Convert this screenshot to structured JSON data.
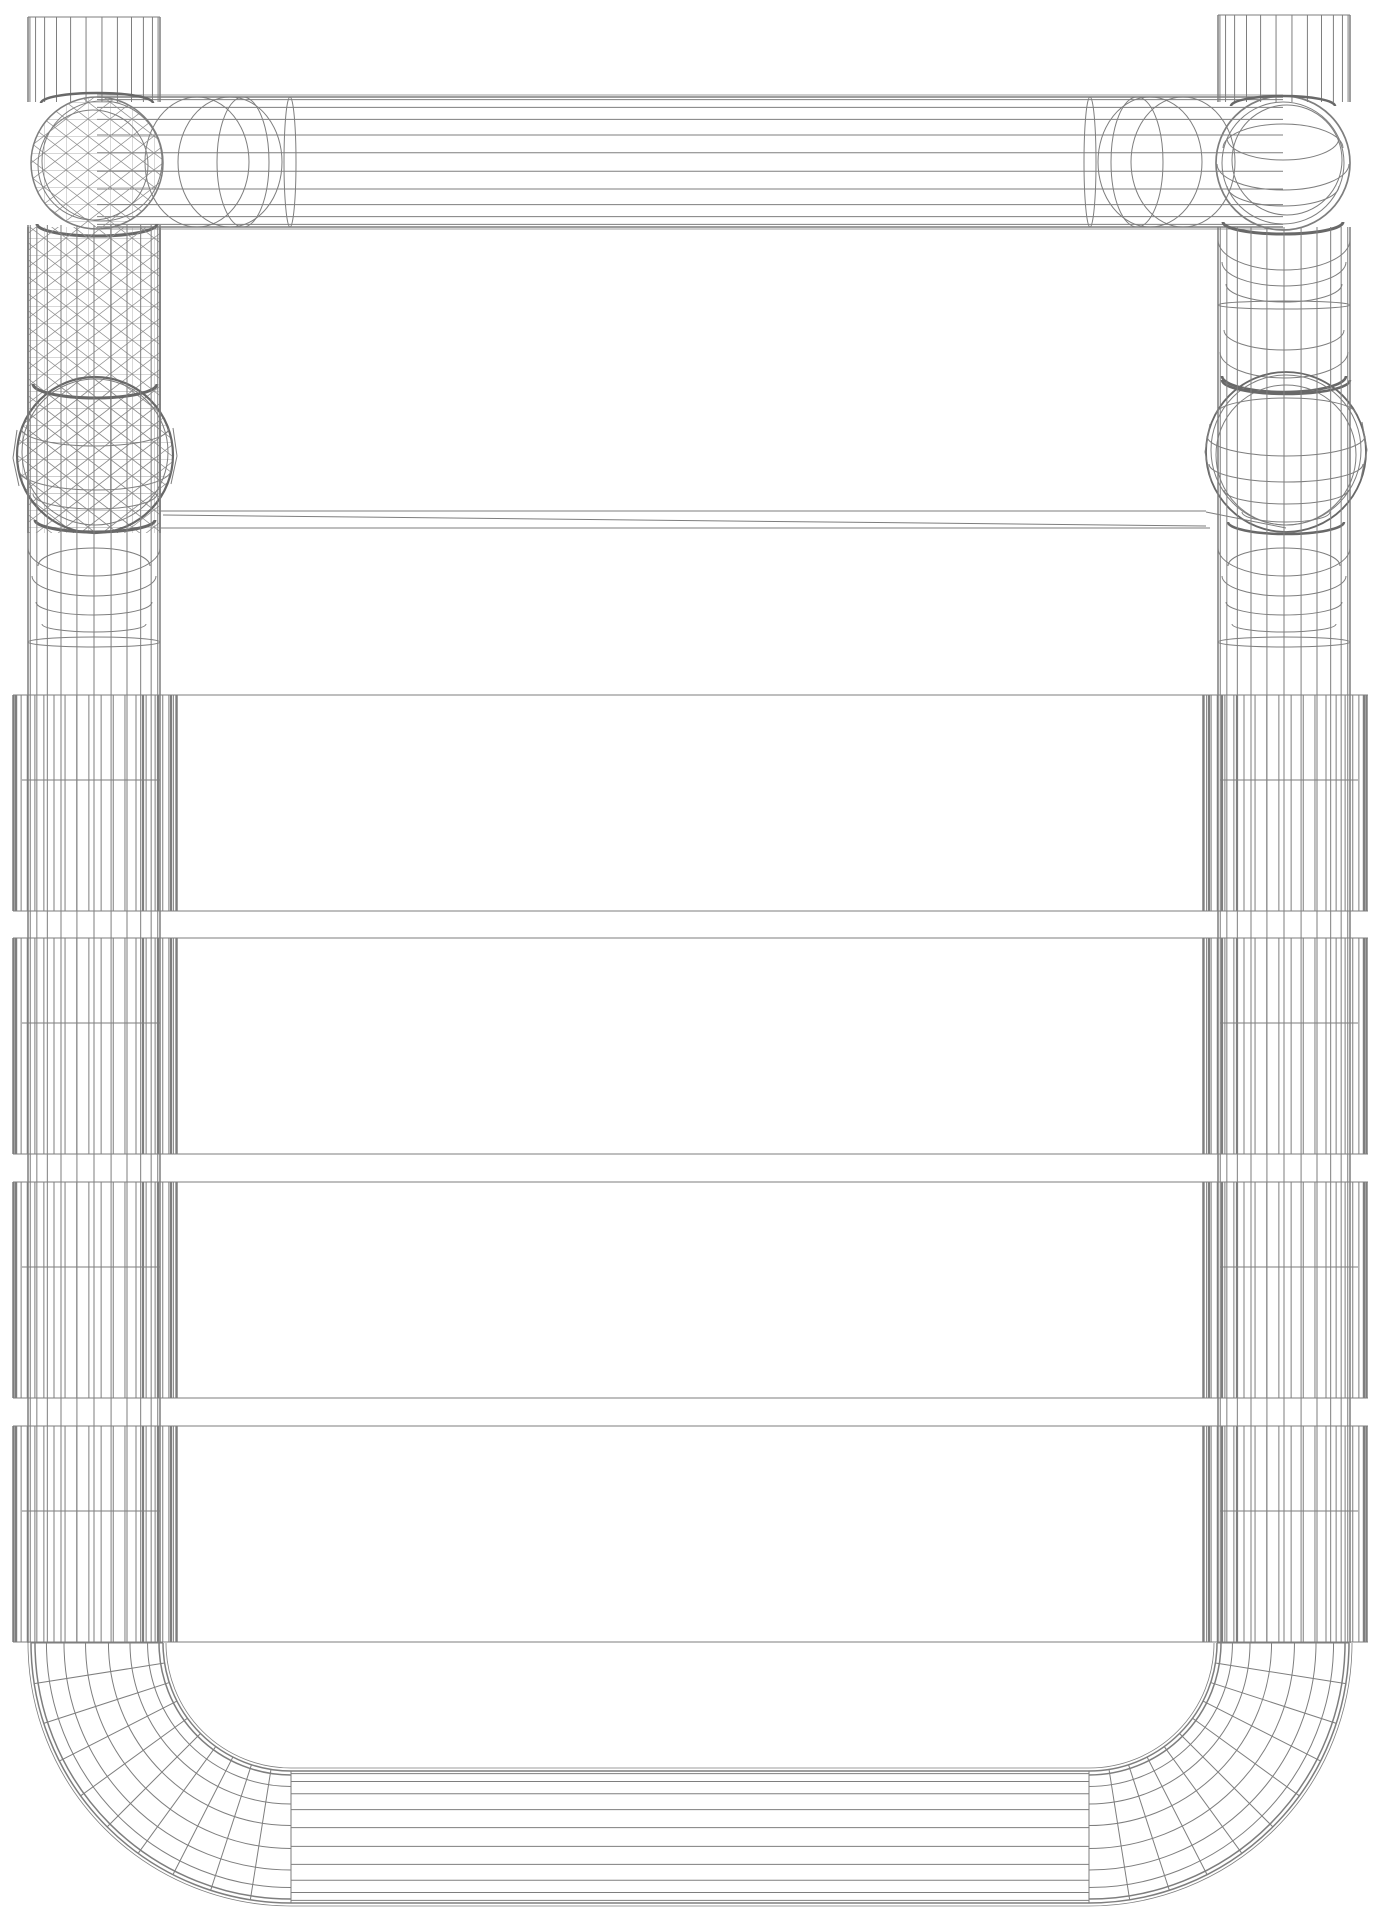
{
  "scene": {
    "width": 1380,
    "height": 1920,
    "background": "#ffffff",
    "stroke_color": "#7e7e7e",
    "stroke_dark": "#686868",
    "mesh_color": "#919191",
    "mesh_tile_w": 22,
    "mesh_tile_h": 17,
    "mesh_stroke_w": 0.7
  },
  "groups": [
    {
      "name": "top-tube",
      "ops": [
        {
          "t": "hset",
          "cy": 162,
          "r": 65,
          "n": 12,
          "x1": 97,
          "x2": 1283
        },
        {
          "t": "line",
          "x1": 97,
          "y1": 95,
          "x2": 1283,
          "y2": 95,
          "w": 0.8
        },
        {
          "t": "line",
          "x1": 97,
          "y1": 229,
          "x2": 1283,
          "y2": 229,
          "w": 0.8
        },
        {
          "t": "ellipse",
          "cx": 197,
          "cy": 162,
          "rx": 52,
          "ry": 65,
          "w": 1
        },
        {
          "t": "ellipse",
          "cx": 230,
          "cy": 162,
          "rx": 52,
          "ry": 65,
          "w": 1
        },
        {
          "t": "ellipse",
          "cx": 243,
          "cy": 162,
          "rx": 26,
          "ry": 65,
          "w": 1
        },
        {
          "t": "ellipse",
          "cx": 290,
          "cy": 162,
          "rx": 6,
          "ry": 65,
          "w": 1
        },
        {
          "t": "ellipse",
          "cx": 1183,
          "cy": 162,
          "rx": 52,
          "ry": 65,
          "w": 1
        },
        {
          "t": "ellipse",
          "cx": 1150,
          "cy": 162,
          "rx": 52,
          "ry": 65,
          "w": 1
        },
        {
          "t": "ellipse",
          "cx": 1137,
          "cy": 162,
          "rx": 26,
          "ry": 65,
          "w": 1
        },
        {
          "t": "ellipse",
          "cx": 1090,
          "cy": 162,
          "rx": 6,
          "ry": 65,
          "w": 1
        }
      ]
    },
    {
      "name": "top-left-stub",
      "ops": [
        {
          "t": "vset",
          "cx": 94,
          "r": 66,
          "n": 14,
          "y1": 17,
          "y2": 102
        },
        {
          "t": "line",
          "x1": 28,
          "y1": 17,
          "x2": 160,
          "y2": 17,
          "w": 1
        }
      ]
    },
    {
      "name": "top-right-stub",
      "ops": [
        {
          "t": "vset",
          "cx": 1284,
          "r": 66,
          "n": 14,
          "y1": 15,
          "y2": 102
        },
        {
          "t": "line",
          "x1": 1218,
          "y1": 15,
          "x2": 1350,
          "y2": 15,
          "w": 1
        }
      ]
    },
    {
      "name": "left-elbow-joint",
      "ops": [
        {
          "t": "meshcircle",
          "cx": 97,
          "cy": 163,
          "r": 66
        },
        {
          "t": "circle",
          "cx": 97,
          "cy": 163,
          "r": 66,
          "w": 1.5
        },
        {
          "t": "circle",
          "cx": 102,
          "cy": 161,
          "r": 60,
          "w": 1
        },
        {
          "t": "circle",
          "cx": 93,
          "cy": 165,
          "r": 55,
          "w": 1
        },
        {
          "t": "arc",
          "cx": 97,
          "cy": 224,
          "rx": 60,
          "ry": 12,
          "half": "b",
          "w": 3,
          "dark": true
        },
        {
          "t": "arc",
          "cx": 97,
          "cy": 103,
          "rx": 56,
          "ry": 10,
          "half": "t",
          "w": 2.5,
          "dark": true
        }
      ]
    },
    {
      "name": "right-elbow-joint",
      "ops": [
        {
          "t": "circle",
          "cx": 1283,
          "cy": 163,
          "r": 67,
          "w": 1.7
        },
        {
          "t": "circle",
          "cx": 1283,
          "cy": 163,
          "r": 61,
          "w": 1
        },
        {
          "t": "circle",
          "cx": 1287,
          "cy": 160,
          "r": 55,
          "w": 1
        },
        {
          "t": "arc",
          "cx": 1283,
          "cy": 138,
          "rx": 56,
          "ry": 22,
          "half": "b",
          "w": 1
        },
        {
          "t": "arc",
          "cx": 1283,
          "cy": 164,
          "rx": 66,
          "ry": 26,
          "half": "b",
          "w": 1
        },
        {
          "t": "arc",
          "cx": 1283,
          "cy": 186,
          "rx": 56,
          "ry": 20,
          "half": "b",
          "w": 1
        },
        {
          "t": "arc",
          "cx": 1283,
          "cy": 148,
          "rx": 60,
          "ry": 24,
          "half": "t",
          "w": 1
        },
        {
          "t": "arc",
          "cx": 1283,
          "cy": 222,
          "rx": 60,
          "ry": 12,
          "half": "b",
          "w": 3,
          "dark": true
        },
        {
          "t": "arc",
          "cx": 1283,
          "cy": 106,
          "rx": 52,
          "ry": 10,
          "half": "t",
          "w": 2.5,
          "dark": true
        }
      ]
    },
    {
      "name": "left-tube-mesh-section",
      "ops": [
        {
          "t": "meshrect",
          "x": 28,
          "y": 227,
          "w": 132,
          "h": 306
        },
        {
          "t": "line",
          "x1": 28,
          "y1": 227,
          "x2": 28,
          "y2": 533,
          "w": 1.8
        },
        {
          "t": "line",
          "x1": 160,
          "y1": 227,
          "x2": 160,
          "y2": 533,
          "w": 1.8
        }
      ]
    },
    {
      "name": "right-tube-upper-rings",
      "ops": [
        {
          "t": "arc",
          "cx": 1284,
          "cy": 240,
          "rx": 66,
          "ry": 30,
          "half": "b",
          "w": 1
        },
        {
          "t": "arc",
          "cx": 1284,
          "cy": 262,
          "rx": 62,
          "ry": 24,
          "half": "b",
          "w": 1
        },
        {
          "t": "arc",
          "cx": 1284,
          "cy": 284,
          "rx": 58,
          "ry": 18,
          "half": "b",
          "w": 1
        },
        {
          "t": "ellipse",
          "cx": 1284,
          "cy": 305,
          "rx": 66,
          "ry": 4,
          "w": 1
        },
        {
          "t": "arc",
          "cx": 1284,
          "cy": 330,
          "rx": 60,
          "ry": 20,
          "half": "b",
          "w": 1
        },
        {
          "t": "arc",
          "cx": 1284,
          "cy": 352,
          "rx": 64,
          "ry": 26,
          "half": "b",
          "w": 1
        },
        {
          "t": "arc",
          "cx": 1284,
          "cy": 376,
          "rx": 62,
          "ry": 16,
          "half": "b",
          "w": 2.6,
          "dark": true
        }
      ]
    },
    {
      "name": "left-sphere-joint",
      "ops": [
        {
          "t": "meshcircle",
          "cx": 95,
          "cy": 455,
          "r": 78
        },
        {
          "t": "circle",
          "cx": 95,
          "cy": 455,
          "r": 78,
          "w": 2.2,
          "dark": true
        },
        {
          "t": "circle",
          "cx": 95,
          "cy": 452,
          "r": 73,
          "w": 1
        },
        {
          "t": "arc",
          "cx": 95,
          "cy": 428,
          "rx": 74,
          "ry": 18,
          "half": "b",
          "w": 1
        },
        {
          "t": "arc",
          "cx": 95,
          "cy": 470,
          "rx": 76,
          "ry": 20,
          "half": "b",
          "w": 1
        },
        {
          "t": "arc",
          "cx": 95,
          "cy": 494,
          "rx": 62,
          "ry": 15,
          "half": "b",
          "w": 1
        },
        {
          "t": "arc",
          "cx": 95,
          "cy": 384,
          "rx": 62,
          "ry": 14,
          "half": "b",
          "w": 3,
          "dark": true
        },
        {
          "t": "arc",
          "cx": 95,
          "cy": 520,
          "rx": 60,
          "ry": 12,
          "half": "b",
          "w": 3,
          "dark": true
        },
        {
          "t": "line",
          "x1": 17,
          "y1": 430,
          "x2": 13,
          "y2": 458,
          "w": 1
        },
        {
          "t": "line",
          "x1": 13,
          "y1": 458,
          "x2": 19,
          "y2": 486,
          "w": 1
        },
        {
          "t": "line",
          "x1": 173,
          "y1": 428,
          "x2": 177,
          "y2": 456,
          "w": 1
        },
        {
          "t": "line",
          "x1": 177,
          "y1": 456,
          "x2": 171,
          "y2": 484,
          "w": 1
        }
      ]
    },
    {
      "name": "right-sphere-joint",
      "ops": [
        {
          "t": "circle",
          "cx": 1286,
          "cy": 452,
          "r": 80,
          "w": 1.8,
          "dark": true
        },
        {
          "t": "circle",
          "cx": 1286,
          "cy": 450,
          "r": 75,
          "w": 1
        },
        {
          "t": "circle",
          "cx": 1286,
          "cy": 455,
          "r": 70,
          "w": 1
        },
        {
          "t": "arc",
          "cx": 1286,
          "cy": 414,
          "rx": 70,
          "ry": 16,
          "half": "t",
          "w": 1
        },
        {
          "t": "arc",
          "cx": 1286,
          "cy": 436,
          "rx": 79,
          "ry": 20,
          "half": "b",
          "w": 1
        },
        {
          "t": "arc",
          "cx": 1286,
          "cy": 464,
          "rx": 77,
          "ry": 18,
          "half": "b",
          "w": 1
        },
        {
          "t": "arc",
          "cx": 1286,
          "cy": 490,
          "rx": 62,
          "ry": 14,
          "half": "b",
          "w": 1
        },
        {
          "t": "arc",
          "cx": 1286,
          "cy": 512,
          "rx": 44,
          "ry": 10,
          "half": "b",
          "w": 1
        },
        {
          "t": "arc",
          "cx": 1286,
          "cy": 380,
          "rx": 64,
          "ry": 14,
          "half": "b",
          "w": 2.5,
          "dark": true
        },
        {
          "t": "arc",
          "cx": 1286,
          "cy": 522,
          "rx": 58,
          "ry": 12,
          "half": "b",
          "w": 2.5,
          "dark": true
        },
        {
          "t": "line",
          "x1": 1210,
          "y1": 424,
          "x2": 1205,
          "y2": 452,
          "w": 1
        },
        {
          "t": "line",
          "x1": 1205,
          "y1": 452,
          "x2": 1211,
          "y2": 480,
          "w": 1
        },
        {
          "t": "line",
          "x1": 1362,
          "y1": 422,
          "x2": 1367,
          "y2": 450,
          "w": 1
        },
        {
          "t": "line",
          "x1": 1367,
          "y1": 450,
          "x2": 1361,
          "y2": 478,
          "w": 1
        },
        {
          "t": "line",
          "x1": 1206,
          "y1": 512,
          "x2": 1286,
          "y2": 528,
          "w": 1
        }
      ]
    },
    {
      "name": "left-tube-lower-rings",
      "ops": [
        {
          "t": "arc",
          "cx": 94,
          "cy": 548,
          "rx": 66,
          "ry": 28,
          "half": "b",
          "w": 1
        },
        {
          "t": "arc",
          "cx": 94,
          "cy": 576,
          "rx": 62,
          "ry": 20,
          "half": "b",
          "w": 1
        },
        {
          "t": "arc",
          "cx": 94,
          "cy": 566,
          "rx": 56,
          "ry": 18,
          "half": "t",
          "w": 1
        },
        {
          "t": "arc",
          "cx": 94,
          "cy": 602,
          "rx": 58,
          "ry": 13,
          "half": "b",
          "w": 1
        },
        {
          "t": "arc",
          "cx": 94,
          "cy": 624,
          "rx": 52,
          "ry": 8,
          "half": "b",
          "w": 1
        },
        {
          "t": "ellipse",
          "cx": 94,
          "cy": 642,
          "rx": 66,
          "ry": 5,
          "w": 1
        }
      ]
    },
    {
      "name": "right-tube-lower-rings",
      "ops": [
        {
          "t": "arc",
          "cx": 1284,
          "cy": 548,
          "rx": 66,
          "ry": 28,
          "half": "b",
          "w": 1
        },
        {
          "t": "arc",
          "cx": 1284,
          "cy": 576,
          "rx": 62,
          "ry": 20,
          "half": "b",
          "w": 1
        },
        {
          "t": "arc",
          "cx": 1284,
          "cy": 566,
          "rx": 56,
          "ry": 18,
          "half": "t",
          "w": 1
        },
        {
          "t": "arc",
          "cx": 1284,
          "cy": 602,
          "rx": 58,
          "ry": 13,
          "half": "b",
          "w": 1
        },
        {
          "t": "arc",
          "cx": 1284,
          "cy": 624,
          "rx": 52,
          "ry": 8,
          "half": "b",
          "w": 1
        },
        {
          "t": "ellipse",
          "cx": 1284,
          "cy": 642,
          "rx": 66,
          "ry": 5,
          "w": 1
        }
      ]
    },
    {
      "name": "side-tube-verticals",
      "ops": [
        {
          "t": "vset",
          "cx": 94,
          "r": 66,
          "n": 13,
          "y1": 225,
          "y2": 1643
        },
        {
          "t": "vset",
          "cx": 1284,
          "r": 66,
          "n": 13,
          "y1": 227,
          "y2": 1643
        }
      ]
    },
    {
      "name": "thin-rung",
      "ops": [
        {
          "t": "line",
          "x1": 160,
          "y1": 511,
          "x2": 1206,
          "y2": 511,
          "w": 1
        },
        {
          "t": "line",
          "x1": 160,
          "y1": 528,
          "x2": 1210,
          "y2": 528,
          "w": 1
        },
        {
          "t": "line",
          "x1": 163,
          "y1": 515,
          "x2": 1206,
          "y2": 526,
          "w": 1
        }
      ]
    },
    {
      "name": "left-bottom-bend",
      "ops": [
        {
          "t": "bend",
          "cx": 291,
          "cy": 1643,
          "r1": 128,
          "r2": 260,
          "nl": 10,
          "nr": 11,
          "side": "l"
        }
      ]
    },
    {
      "name": "right-bottom-bend",
      "ops": [
        {
          "t": "bend",
          "cx": 1089,
          "cy": 1643,
          "r1": 128,
          "r2": 260,
          "nl": 10,
          "nr": 11,
          "side": "r"
        }
      ]
    },
    {
      "name": "bottom-tube",
      "ops": [
        {
          "t": "hset",
          "cy": 1837,
          "r": 66,
          "n": 12,
          "x1": 291,
          "x2": 1089
        },
        {
          "t": "line",
          "x1": 291,
          "y1": 1768,
          "x2": 1089,
          "y2": 1768,
          "w": 0.8
        },
        {
          "t": "line",
          "x1": 291,
          "y1": 1906,
          "x2": 1089,
          "y2": 1906,
          "w": 0.8
        }
      ]
    }
  ],
  "bands": {
    "tops": [
      695,
      938,
      1182,
      1426
    ],
    "height": 216,
    "x1": 13,
    "x2": 1368,
    "mid_dy": 85,
    "mid_left": [
      22,
      160
    ],
    "mid_right": [
      1220,
      1358
    ],
    "cap_left": {
      "cx": 95,
      "r": 82,
      "n": 22
    },
    "cap_right": {
      "cx": 1285,
      "r": 82,
      "n": 22
    },
    "thick_left": [
      16,
      143,
      158,
      171
    ],
    "thick_right": [
      1209,
      1222,
      1237,
      1364
    ],
    "thick_w": 2.2
  }
}
